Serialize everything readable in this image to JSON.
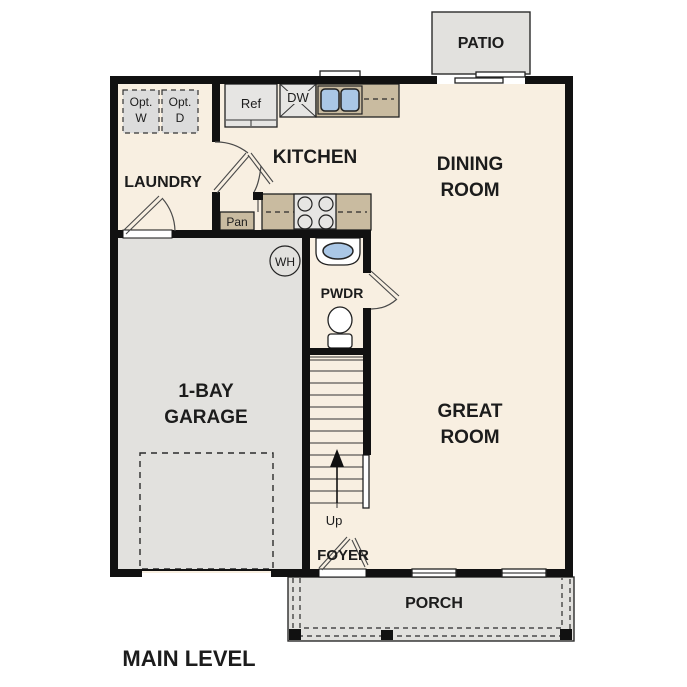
{
  "title": "MAIN LEVEL",
  "rooms": {
    "patio": "PATIO",
    "kitchen": "KITCHEN",
    "dining_line1": "DINING",
    "dining_line2": "ROOM",
    "laundry": "LAUNDRY",
    "garage_line1": "1-BAY",
    "garage_line2": "GARAGE",
    "great_line1": "GREAT",
    "great_line2": "ROOM",
    "pwdr": "PWDR",
    "foyer": "FOYER",
    "porch": "PORCH"
  },
  "fixtures": {
    "refrigerator": "Ref",
    "dishwasher": "DW",
    "pantry": "Pan",
    "water_heater": "WH",
    "stairs_direction": "Up",
    "opt_washer_line1": "Opt.",
    "opt_washer_line2": "W",
    "opt_dryer_line1": "Opt.",
    "opt_dryer_line2": "D"
  },
  "colors": {
    "floor": "#f8efe1",
    "outdoor": "#e2e1de",
    "counter": "#c9bba0",
    "sink_basin": "#aac7e6",
    "wall": "#111111",
    "appliance": "#e6e5e3",
    "optional_unit": "#dcdcdc"
  }
}
